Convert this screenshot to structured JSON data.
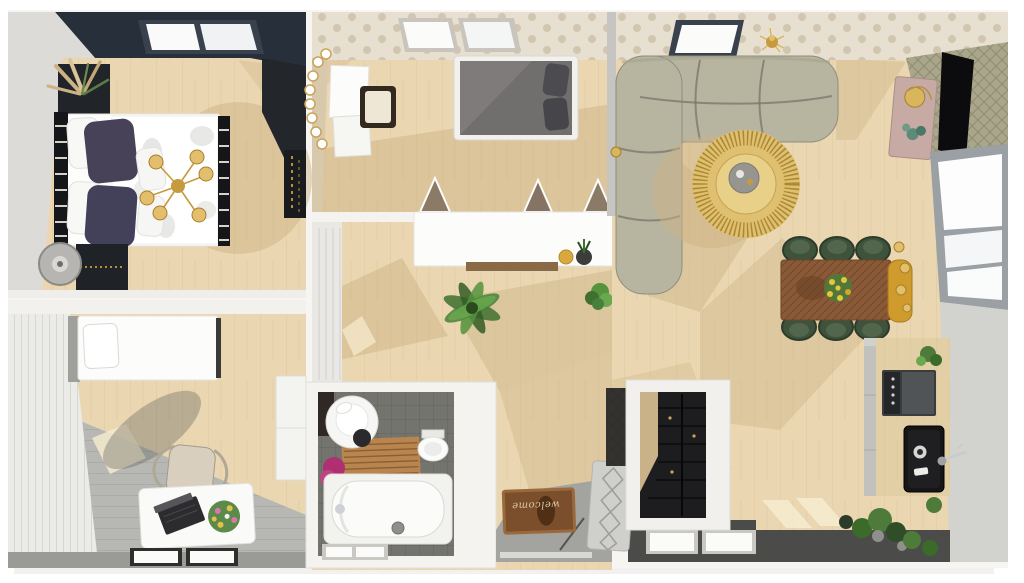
{
  "scene": {
    "title": "3D apartment floor plan — top view"
  },
  "palette": {
    "floor": "#ead7b1",
    "floorShadow": "#cdb186",
    "sunPatch": "#f7ecd0",
    "outside": "#f6f5f2",
    "wallDark": "#27303a",
    "wallGray": "#dcdbd7",
    "dotBg": "#e7e0d1",
    "dot": "#d2c6b1",
    "wallGreen": "#a9a68a",
    "grayFloor": "#a3a3a0",
    "bathFloor": "#74746e",
    "darkFloor": "#4b4b49",
    "sofa": "#b7b5a0",
    "sofaSeam": "#77766a",
    "gold": "#c89a3f",
    "goldLight": "#e3bf6d",
    "tableBrown": "#8a5a38",
    "chairGreen": "#3f523c",
    "benchYellow": "#cf9b2c",
    "mauve": "#c7aaa4",
    "duvetGray": "#716e6e",
    "woodMat": "#b9854e",
    "towelMagenta": "#b02f72",
    "plantGreen": "#4e7a3a",
    "matBrown": "#7c4f2c"
  },
  "entry": {
    "doormat_text": "welcome"
  },
  "rooms": [
    {
      "id": "bedroom",
      "label": "Bedroom",
      "items": [
        "double-bed",
        "pillows",
        "sputnik-chandelier",
        "nightstand",
        "wardrobe",
        "floor-lamp",
        "pampas-plant",
        "skylight"
      ]
    },
    {
      "id": "office",
      "label": "Office / Guest Room",
      "items": [
        "single-bed",
        "desk",
        "laptop",
        "bouquet",
        "chair",
        "cabinet",
        "windows"
      ]
    },
    {
      "id": "kids-bedroom",
      "label": "Kids Bedroom",
      "items": [
        "bed",
        "vanity-with-lighted-mirror",
        "stool",
        "wall-pennants",
        "skylights"
      ]
    },
    {
      "id": "hallway",
      "label": "Hallway",
      "items": [
        "white-console",
        "wood-shelf",
        "vase",
        "potted-plants"
      ]
    },
    {
      "id": "bathroom",
      "label": "Bathroom",
      "items": [
        "round-sink",
        "toilet",
        "bath-mat",
        "bathtub",
        "towel",
        "window"
      ]
    },
    {
      "id": "entry",
      "label": "Entry",
      "items": [
        "doormat",
        "radiator-panel",
        "front-door"
      ]
    },
    {
      "id": "closet",
      "label": "Walk-in Closet",
      "items": [
        "black-shelving"
      ]
    },
    {
      "id": "living-room",
      "label": "Living Room",
      "items": [
        "sectional-sofa",
        "fringe-coffee-table",
        "tv",
        "tv-sideboard",
        "ceiling-light",
        "dining-table",
        "dining-chairs",
        "bench",
        "pendant-lights",
        "kitchen-counter",
        "stove",
        "sink",
        "window-wall",
        "plants"
      ]
    }
  ]
}
